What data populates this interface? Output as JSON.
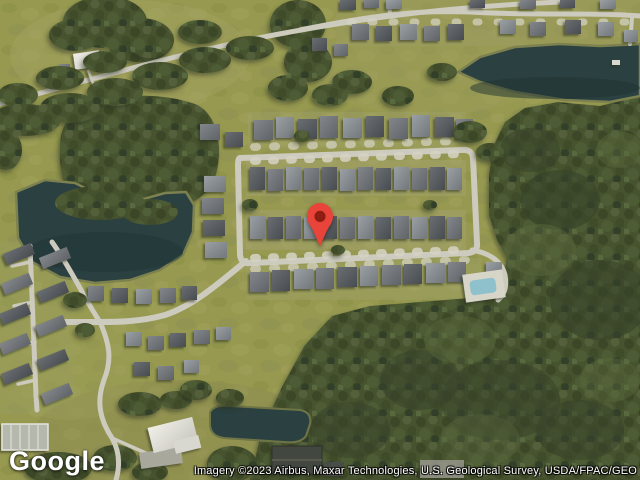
{
  "map": {
    "view_type": "satellite",
    "marker": {
      "name": "location-pin",
      "pin_color": "#e8443a",
      "dot_color": "#8e1d12"
    },
    "colors": {
      "water": "#2b4141",
      "forest": "#46522e",
      "grass": "#96994f",
      "road": "#cdcabe",
      "roof_dark": "#55585c",
      "roof_light": "#8b9094"
    }
  },
  "branding": {
    "logo_text": "Google"
  },
  "attribution": {
    "text": "Imagery ©2023 Airbus, Maxar Technologies, U.S. Geological Survey, USDA/FPAC/GEO"
  }
}
